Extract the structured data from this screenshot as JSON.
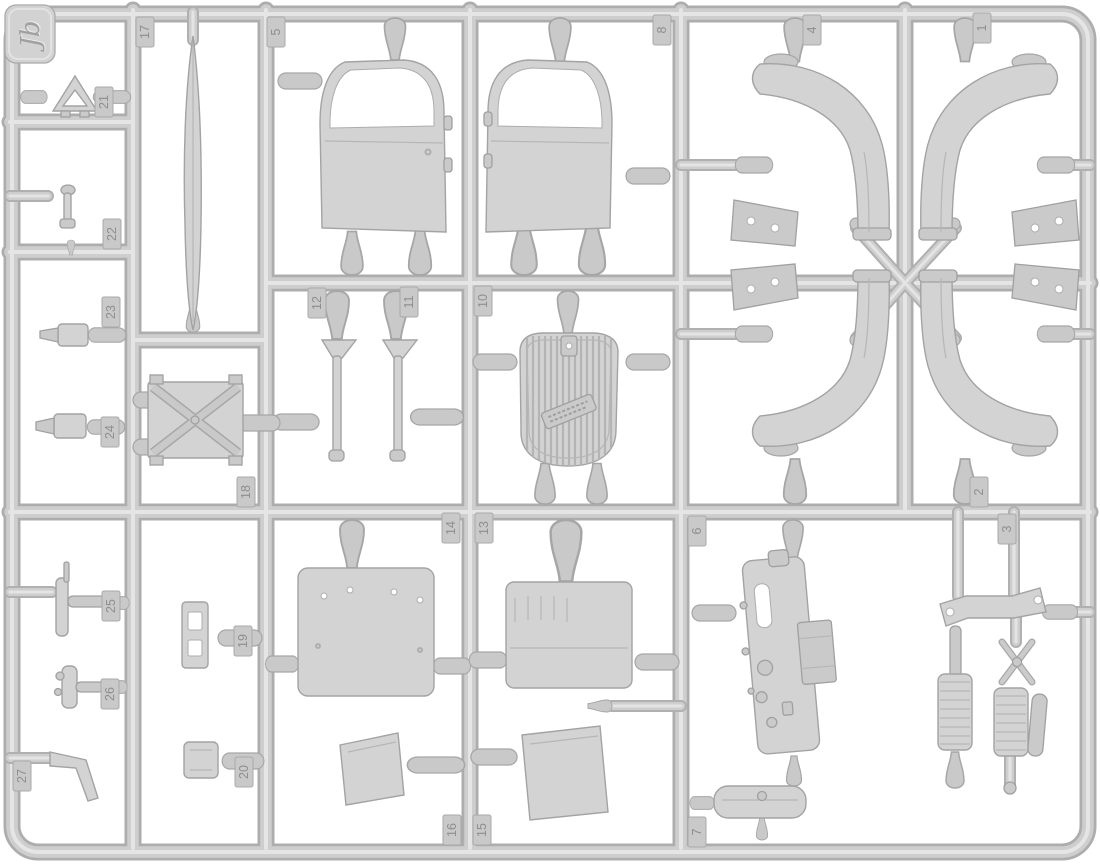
{
  "colors": {
    "background": "#ffffff",
    "plastic": "#d3d3d3",
    "runner-shadow": "#adadad",
    "runner-mid": "#cecece",
    "runner-highlight": "#e5e5e5",
    "outline": "#a3a3a3",
    "label-text": "#8e8e8e"
  },
  "logo": {
    "text": "Jb"
  },
  "labels": {
    "t1": "1",
    "t2": "2",
    "t3": "3",
    "t4": "4",
    "t5": "5",
    "t6": "6",
    "t7": "7",
    "t8": "8",
    "t10": "10",
    "t11": "11",
    "t12": "12",
    "t13": "13",
    "t14": "14",
    "t15": "15",
    "t16": "16",
    "t17": "17",
    "t18": "18",
    "t19": "19",
    "t20": "20",
    "t21": "21",
    "t22": "22",
    "t23": "23",
    "t24": "24",
    "t25": "25",
    "t26": "26",
    "t27": "27"
  }
}
